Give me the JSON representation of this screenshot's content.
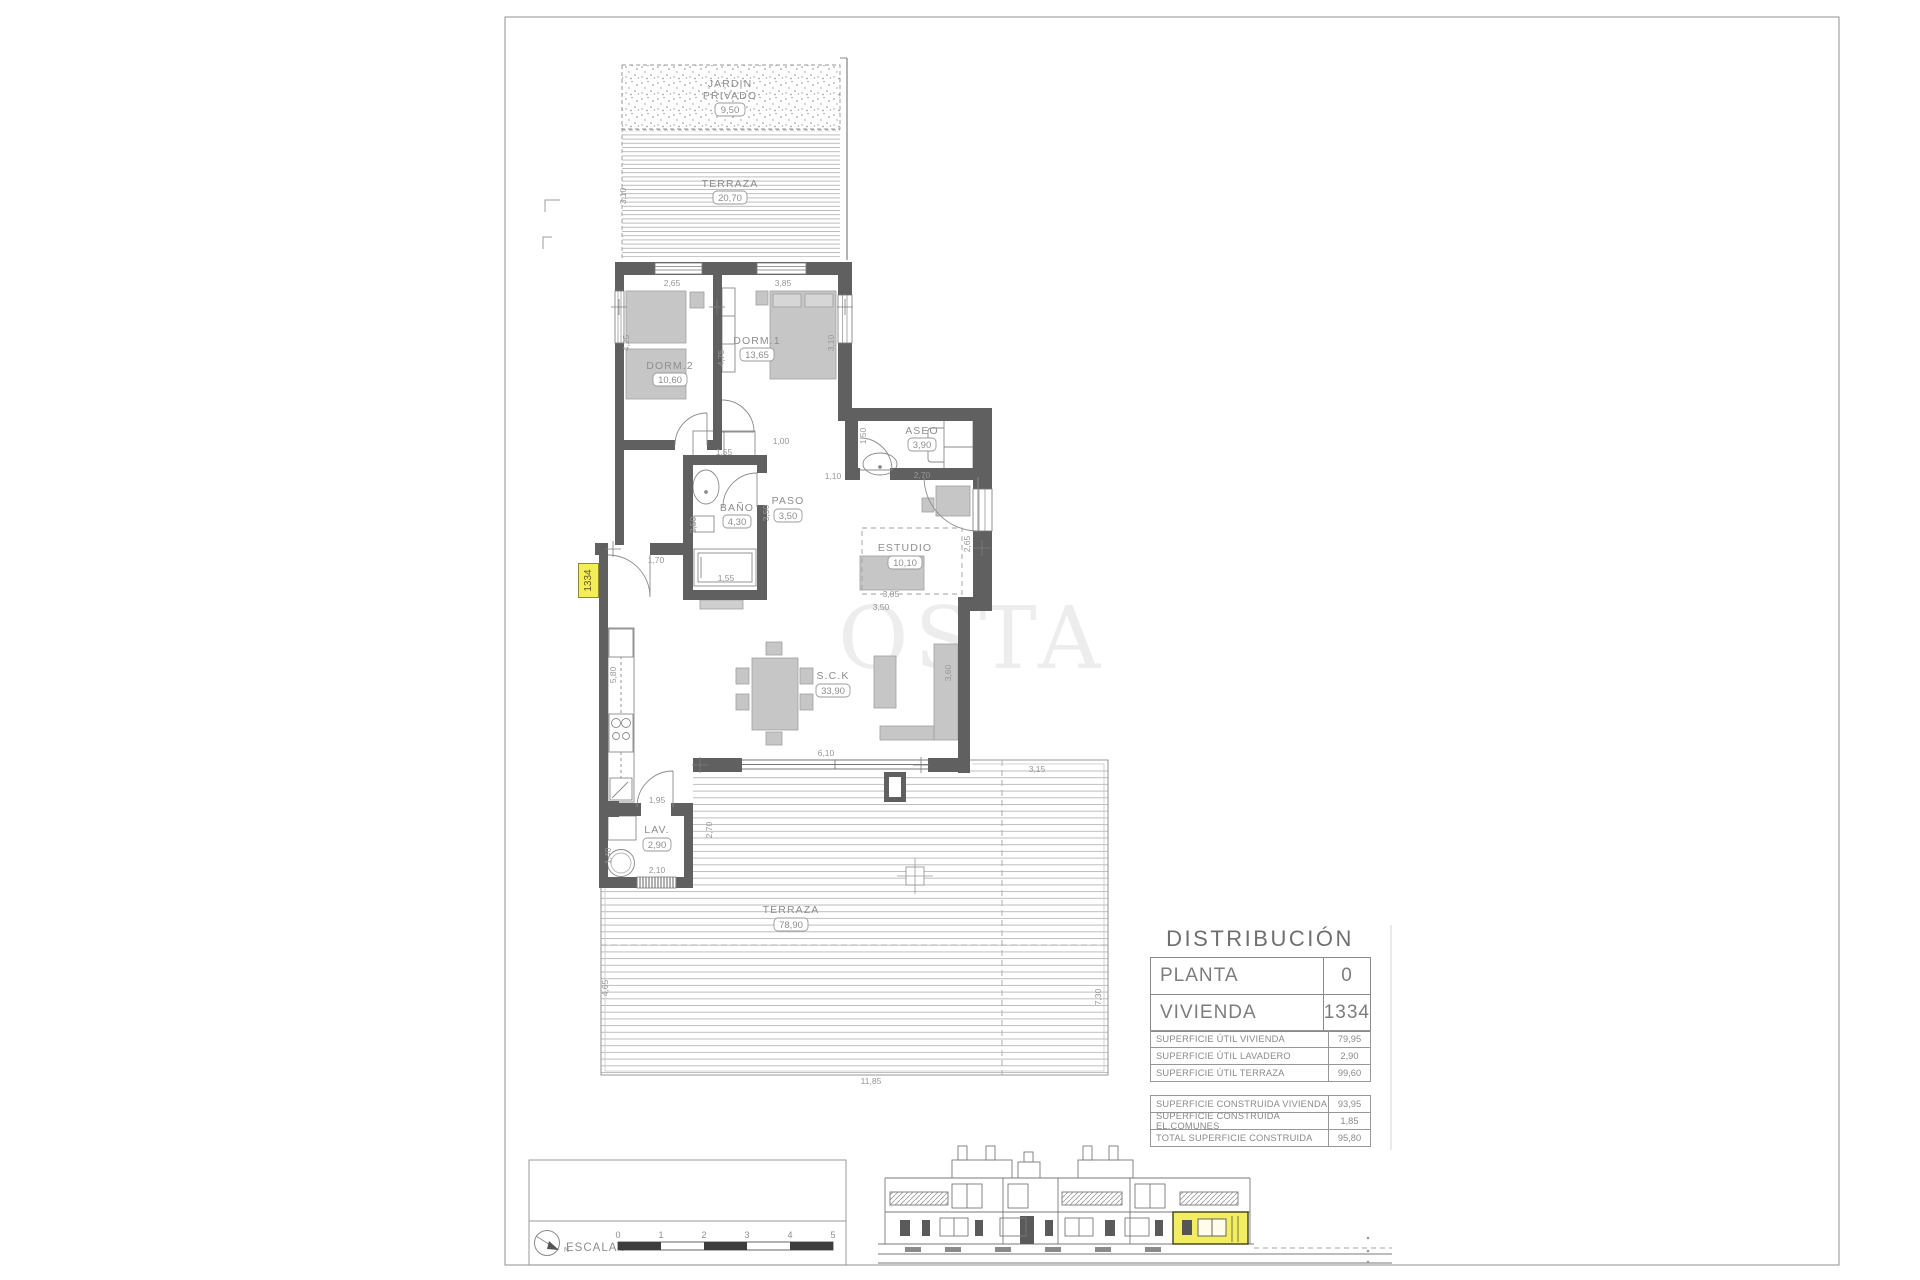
{
  "sheet": {
    "unit_tag": "1334",
    "watermark": "OSTA"
  },
  "plan": {
    "rooms": {
      "jardin": {
        "line1": "JARDIN",
        "line2": "PRIVADO",
        "area": "9,50"
      },
      "terraza_sup": {
        "label": "TERRAZA",
        "area": "20,70"
      },
      "dorm2": {
        "label": "DORM.2",
        "area": "10,60"
      },
      "dorm1": {
        "label": "DORM.1",
        "area": "13,65"
      },
      "aseo": {
        "label": "ASEO",
        "area": "3,90"
      },
      "bano": {
        "label": "BAÑO",
        "area": "4,30"
      },
      "paso": {
        "label": "PASO",
        "area": "3,50"
      },
      "estudio": {
        "label": "ESTUDIO",
        "area": "10,10"
      },
      "sck": {
        "label": "S.C.K",
        "area": "33,90"
      },
      "lav": {
        "label": "LAV.",
        "area": "2,90"
      },
      "terraza_inf": {
        "label": "TERRAZA",
        "area": "78,90"
      }
    },
    "dims": {
      "terraza_sup_alto": "3,10",
      "vent_dorm2": "2,65",
      "vent_dorm1": "3,85",
      "dorm2_alto": "4,25",
      "dorm1_alto": "4,75",
      "dorm1_ancho": "3,10",
      "armario_dorm2": "1,55",
      "paso_sup": "1,00",
      "paso_aseo": "1,10",
      "aseo_alto": "1,50",
      "aseo_ancho": "2,70",
      "bano_alto": "2,50",
      "paso_alto": "3,50",
      "bano_ancho": "1,55",
      "entrada": "1,70",
      "estudio_alto": "2,65",
      "estudio_ancho": "3,85",
      "estudio_inf": "3,50",
      "cocina_alto": "5,80",
      "salon_alto": "3,60",
      "salon_ancho": "6,10",
      "lav_puerta": "1,95",
      "lav_ancho": "2,10",
      "lav_alto": "2,70",
      "lavadora": "1,40",
      "terraza_sup_der": "3,15",
      "terraza_der_alto": "7,30",
      "terraza_izq_alto": "4,65",
      "terraza_ancho": "11,85"
    }
  },
  "distribution": {
    "title": "DISTRIBUCIÓN",
    "rows": [
      {
        "label": "PLANTA",
        "value": "0"
      },
      {
        "label": "VIVIENDA",
        "value": "1334"
      }
    ]
  },
  "surfaces_util": {
    "rows": [
      {
        "label": "SUPERFICIE ÚTIL VIVIENDA",
        "value": "79,95"
      },
      {
        "label": "SUPERFICIE ÚTIL LAVADERO",
        "value": "2,90"
      },
      {
        "label": "SUPERFICIE ÚTIL TERRAZA",
        "value": "99,60"
      }
    ]
  },
  "surfaces_built": {
    "rows": [
      {
        "label": "SUPERFICIE CONSTRUIDA VIVIENDA",
        "value": "93,95"
      },
      {
        "label": "SUPERFICIE CONSTRUIDA EL.COMUNES",
        "value": "1,85"
      },
      {
        "label": "TOTAL SUPERFICIE CONSTRUIDA",
        "value": "95,80"
      }
    ]
  },
  "scale": {
    "label": "ESCALA :",
    "north": "N",
    "ticks": [
      "0",
      "1",
      "2",
      "3",
      "4",
      "5"
    ]
  }
}
